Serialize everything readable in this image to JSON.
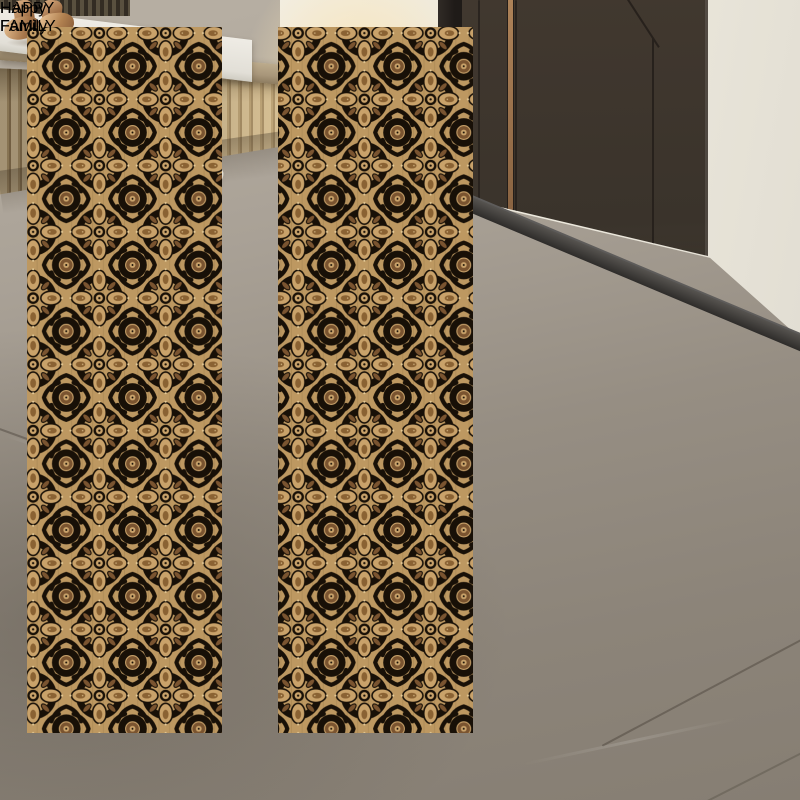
{
  "rug": {
    "stripe_text_primary": "HAPPY FAMILY",
    "stripe_text_secondary": "Happy Family",
    "colors": {
      "field_black": "#1a1309",
      "ground_tan": "#bd9861",
      "motif_brown": "#7a5430",
      "motif_light": "#c9a26a",
      "accent_cream": "#e6cb97",
      "edge_charcoal": "#45413e",
      "edge_white": "#f2eee1",
      "border_tan": "#bf9a62",
      "stripe_tan": "#c8a873"
    }
  },
  "room": {
    "wall_color": "#eee9dd",
    "door_color": "#3e362e",
    "door_frame_color": "#262220",
    "door_inlay_color": "#ad8258",
    "threshold_color": "#3a3837",
    "floor_color": "#a49c91",
    "slat_wood_color": "#c4b392",
    "marble_top_color": "#eae7e0",
    "baseboard_color": "#55504a"
  },
  "objects": {
    "figurine": {
      "name": "bronze-figurine",
      "color": "#b98a62"
    },
    "loafers": {
      "name": "brown-loafers",
      "color": "#5d4730"
    },
    "sneakers": {
      "name": "white-sneakers",
      "color": "#f3f0e7"
    },
    "slippers": {
      "name": "cream-slippers",
      "color": "#e4dbc9"
    }
  }
}
